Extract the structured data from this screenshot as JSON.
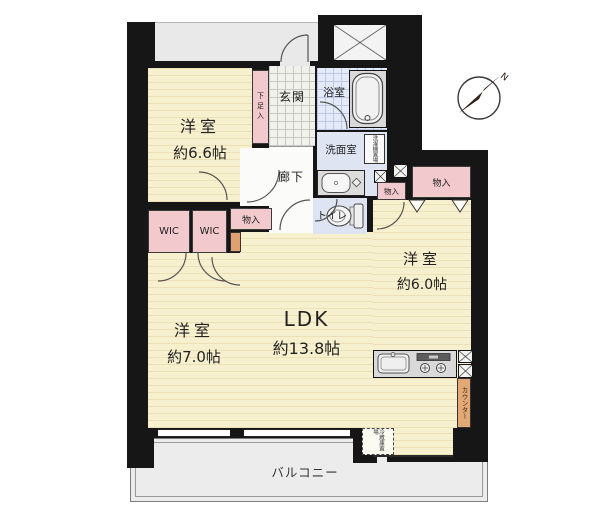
{
  "plan": {
    "rooms": {
      "bedroom1": {
        "name": "洋室",
        "size": "約6.6帖"
      },
      "bedroom2": {
        "name": "洋室",
        "size": "約7.0帖"
      },
      "bedroom3": {
        "name": "洋室",
        "size": "約6.0帖"
      },
      "ldk": {
        "name": "LDK",
        "size": "約13.8帖"
      },
      "entrance": "玄関",
      "hallway": "廊下",
      "bathroom": "浴室",
      "washroom": "洗面室",
      "toilet": "トイレ",
      "balcony": "バルコニー"
    },
    "storage": {
      "shoe_cabinet": "下足入",
      "wic_left": "WIC",
      "wic_right": "WIC",
      "closet_hall": "物入",
      "closet_small": "物入",
      "closet_large": "物入",
      "washer_space": "洗濯機置場",
      "fridge_space": "冷蔵庫置場",
      "kitchen_counter": "カウンター"
    },
    "compass": {
      "north": "N"
    },
    "colors": {
      "wall": "#161616",
      "room_floor": "#f7f0cf",
      "closet_pink": "#f2c9cc",
      "water_blue": "#dfe4f3",
      "counter_tan": "#e2a876",
      "balcony_gray": "#ececec"
    }
  }
}
